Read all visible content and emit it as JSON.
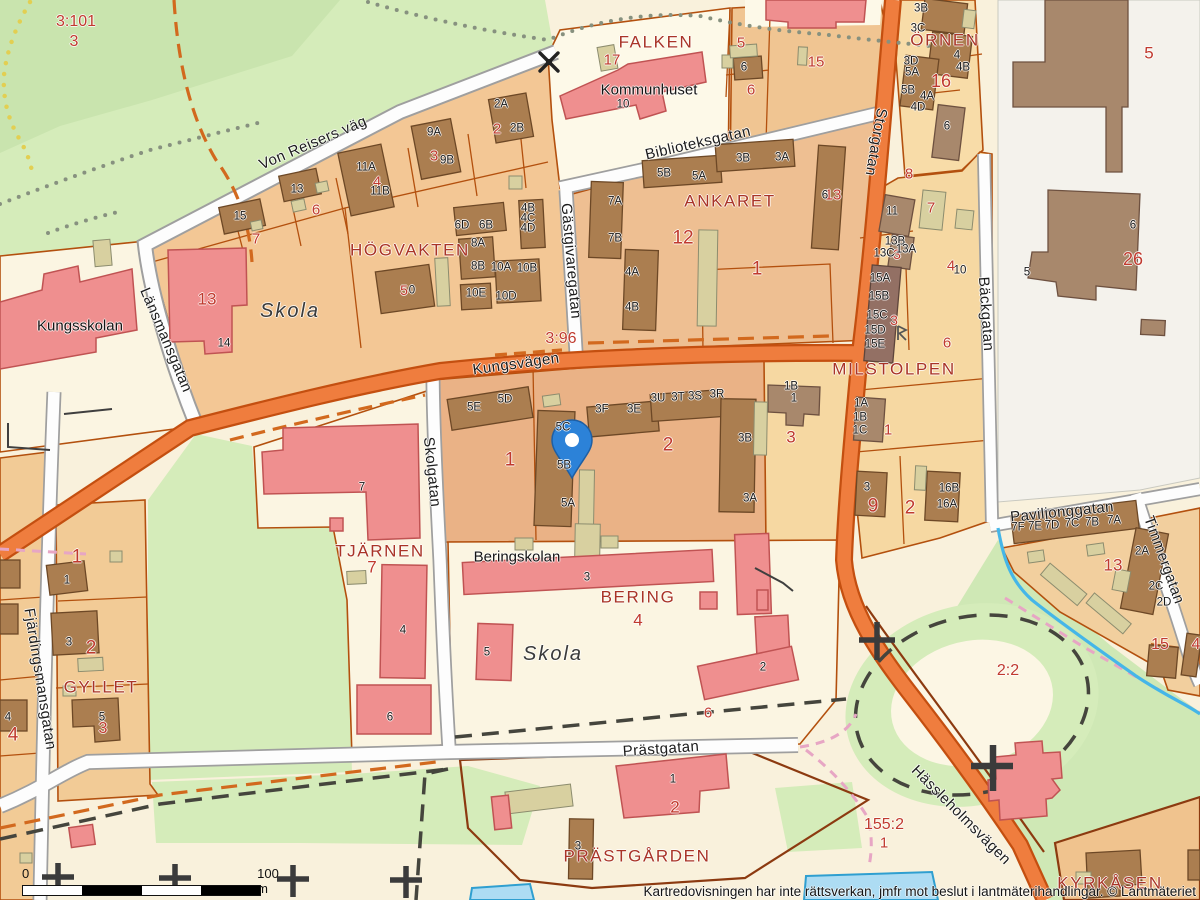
{
  "attribution": "Kartredovisningen har inte rättsverkan, jmfr mot beslut i lantmäterihandlingar. © Lantmäteriet",
  "scalebar": {
    "zero": "0",
    "hundred": "100 m"
  },
  "marker": {
    "x": 572,
    "y": 444,
    "color": "#2c82d8"
  },
  "colors": {
    "road_major": "#ef7d3e",
    "road_major_casing": "#c44f10",
    "road_minor": "#fdfdfd",
    "road_minor_casing": "#9f9f9f",
    "park": "#d5ecba",
    "water": "#addcf3",
    "water_line": "#45b6e8",
    "building": "#ab7e50",
    "public_building": "#ef8f8f",
    "shed": "#d8d0a0",
    "parcel_boundary": "#b3500e",
    "block_name": "#a93427",
    "parcel_number": "#c03a2e",
    "marker_blue": "#2c82d8"
  },
  "labels": {
    "streets": [
      {
        "t": "Von Reisers väg",
        "x": 313,
        "y": 143,
        "r": -23
      },
      {
        "t": "Biblioteksgatan",
        "x": 698,
        "y": 143,
        "r": -13
      },
      {
        "t": "Gästgivaregatan",
        "x": 571,
        "y": 261,
        "r": 85
      },
      {
        "t": "Storgatan",
        "x": 876,
        "y": 142,
        "r": 100
      },
      {
        "t": "Länsmansgatan",
        "x": 166,
        "y": 340,
        "r": 67
      },
      {
        "t": "Skolgatan",
        "x": 432,
        "y": 472,
        "r": 84
      },
      {
        "t": "Kungsvägen",
        "x": 516,
        "y": 364,
        "r": -8
      },
      {
        "t": "Fjärdingsmansgatan",
        "x": 40,
        "y": 679,
        "r": 81
      },
      {
        "t": "Bäckgatan",
        "x": 986,
        "y": 314,
        "r": 86
      },
      {
        "t": "Paviljonggatan",
        "x": 1062,
        "y": 512,
        "r": -6
      },
      {
        "t": "Timmergatan",
        "x": 1164,
        "y": 560,
        "r": 70
      },
      {
        "t": "Prästgatan",
        "x": 661,
        "y": 749,
        "r": -4
      },
      {
        "t": "Hässleholmsvägen",
        "x": 961,
        "y": 815,
        "r": 45
      }
    ],
    "blocks": [
      {
        "t": "FALKEN",
        "x": 656,
        "y": 42
      },
      {
        "t": "ÖRNEN",
        "x": 945,
        "y": 40
      },
      {
        "t": "ANKARET",
        "x": 730,
        "y": 201
      },
      {
        "t": "HÖGVAKTEN",
        "x": 410,
        "y": 250
      },
      {
        "t": "MILSTOLPEN",
        "x": 894,
        "y": 369
      },
      {
        "t": "TJÄRNEN",
        "x": 380,
        "y": 551
      },
      {
        "t": "GYLLET",
        "x": 101,
        "y": 687
      },
      {
        "t": "BERING",
        "x": 638,
        "y": 597
      },
      {
        "t": "PRÄSTGÅRDEN",
        "x": 637,
        "y": 856
      },
      {
        "t": "KYRKÅSEN",
        "x": 1110,
        "y": 883
      }
    ],
    "places": [
      {
        "t": "Kommunhuset",
        "x": 649,
        "y": 90
      },
      {
        "t": "Kungsskolan",
        "x": 80,
        "y": 326
      },
      {
        "t": "Beringskolan",
        "x": 517,
        "y": 557
      },
      {
        "t": "Skola",
        "x": 290,
        "y": 311,
        "i": 1,
        "s": 20
      },
      {
        "t": "Skola",
        "x": 553,
        "y": 654,
        "i": 1,
        "s": 20
      }
    ],
    "parcels_red": [
      {
        "t": "3:101",
        "x": 76,
        "y": 22,
        "s": 16
      },
      {
        "t": "3",
        "x": 74,
        "y": 42,
        "s": 16
      },
      {
        "t": "2",
        "x": 497,
        "y": 129
      },
      {
        "t": "3",
        "x": 434,
        "y": 156
      },
      {
        "t": "4",
        "x": 377,
        "y": 182
      },
      {
        "t": "6",
        "x": 316,
        "y": 210
      },
      {
        "t": "7",
        "x": 256,
        "y": 239
      },
      {
        "t": "17",
        "x": 612,
        "y": 60
      },
      {
        "t": "5",
        "x": 741,
        "y": 43
      },
      {
        "t": "6",
        "x": 751,
        "y": 90
      },
      {
        "t": "15",
        "x": 816,
        "y": 62
      },
      {
        "t": "16",
        "x": 941,
        "y": 81,
        "s": 18
      },
      {
        "t": "8",
        "x": 909,
        "y": 174
      },
      {
        "t": "5",
        "x": 1149,
        "y": 53,
        "s": 17
      },
      {
        "t": "26",
        "x": 1133,
        "y": 259,
        "s": 18
      },
      {
        "t": "7",
        "x": 931,
        "y": 208
      },
      {
        "t": "3",
        "x": 897,
        "y": 254,
        "s": 14
      },
      {
        "t": "4",
        "x": 951,
        "y": 266
      },
      {
        "t": "6",
        "x": 947,
        "y": 343
      },
      {
        "t": "3",
        "x": 894,
        "y": 320,
        "s": 14
      },
      {
        "t": "3:96",
        "x": 561,
        "y": 339,
        "s": 16
      },
      {
        "t": "13",
        "x": 833,
        "y": 195
      },
      {
        "t": "12",
        "x": 683,
        "y": 238,
        "s": 19
      },
      {
        "t": "1",
        "x": 757,
        "y": 269,
        "s": 19
      },
      {
        "t": "13",
        "x": 207,
        "y": 299,
        "s": 17
      },
      {
        "t": "1",
        "x": 510,
        "y": 460,
        "s": 19
      },
      {
        "t": "2",
        "x": 668,
        "y": 445,
        "s": 19
      },
      {
        "t": "3",
        "x": 791,
        "y": 437,
        "s": 17
      },
      {
        "t": "1",
        "x": 888,
        "y": 430
      },
      {
        "t": "9",
        "x": 873,
        "y": 506,
        "s": 19
      },
      {
        "t": "2",
        "x": 910,
        "y": 508,
        "s": 19
      },
      {
        "t": "7",
        "x": 372,
        "y": 567,
        "s": 17
      },
      {
        "t": "1",
        "x": 77,
        "y": 557,
        "s": 19
      },
      {
        "t": "2",
        "x": 91,
        "y": 648,
        "s": 19
      },
      {
        "t": "3",
        "x": 103,
        "y": 729,
        "s": 16
      },
      {
        "t": "4",
        "x": 13,
        "y": 735,
        "s": 19
      },
      {
        "t": "4",
        "x": 638,
        "y": 620,
        "s": 17
      },
      {
        "t": "6",
        "x": 708,
        "y": 713
      },
      {
        "t": "2",
        "x": 675,
        "y": 807,
        "s": 17
      },
      {
        "t": "155:2",
        "x": 884,
        "y": 825,
        "s": 16
      },
      {
        "t": "1",
        "x": 884,
        "y": 843
      },
      {
        "t": "2:2",
        "x": 1008,
        "y": 671,
        "s": 16
      },
      {
        "t": "13",
        "x": 1113,
        "y": 565,
        "s": 17
      },
      {
        "t": "15",
        "x": 1160,
        "y": 645,
        "s": 16
      },
      {
        "t": "4",
        "x": 1196,
        "y": 645,
        "s": 16
      },
      {
        "t": "5",
        "x": 404,
        "y": 290,
        "s": 14
      }
    ],
    "buildings_black": [
      {
        "t": "15",
        "x": 240,
        "y": 217
      },
      {
        "t": "13",
        "x": 297,
        "y": 190
      },
      {
        "t": "11A",
        "x": 366,
        "y": 168
      },
      {
        "t": "11B",
        "x": 380,
        "y": 192
      },
      {
        "t": "9A",
        "x": 434,
        "y": 133
      },
      {
        "t": "9B",
        "x": 447,
        "y": 161
      },
      {
        "t": "2A",
        "x": 501,
        "y": 105
      },
      {
        "t": "2B",
        "x": 517,
        "y": 129
      },
      {
        "t": "10",
        "x": 623,
        "y": 105
      },
      {
        "t": "6",
        "x": 744,
        "y": 68
      },
      {
        "t": "3B",
        "x": 921,
        "y": 9
      },
      {
        "t": "3C",
        "x": 918,
        "y": 29
      },
      {
        "t": "3D",
        "x": 911,
        "y": 62
      },
      {
        "t": "5A",
        "x": 912,
        "y": 73
      },
      {
        "t": "5B",
        "x": 908,
        "y": 91
      },
      {
        "t": "4A",
        "x": 927,
        "y": 97
      },
      {
        "t": "4D",
        "x": 918,
        "y": 108
      },
      {
        "t": "4",
        "x": 957,
        "y": 56
      },
      {
        "t": "4B",
        "x": 963,
        "y": 68
      },
      {
        "t": "6",
        "x": 947,
        "y": 127
      },
      {
        "t": "6",
        "x": 1133,
        "y": 226
      },
      {
        "t": "5",
        "x": 1027,
        "y": 273
      },
      {
        "t": "6D",
        "x": 462,
        "y": 226
      },
      {
        "t": "6B",
        "x": 486,
        "y": 226
      },
      {
        "t": "4B",
        "x": 528,
        "y": 209
      },
      {
        "t": "4C",
        "x": 528,
        "y": 219
      },
      {
        "t": "4D",
        "x": 528,
        "y": 229
      },
      {
        "t": "8A",
        "x": 478,
        "y": 244
      },
      {
        "t": "8B",
        "x": 478,
        "y": 267
      },
      {
        "t": "10A",
        "x": 501,
        "y": 268
      },
      {
        "t": "10B",
        "x": 527,
        "y": 269
      },
      {
        "t": "10E",
        "x": 476,
        "y": 294
      },
      {
        "t": "10D",
        "x": 506,
        "y": 297
      },
      {
        "t": "0",
        "x": 412,
        "y": 291
      },
      {
        "t": "5B",
        "x": 664,
        "y": 174
      },
      {
        "t": "5A",
        "x": 699,
        "y": 177
      },
      {
        "t": "3B",
        "x": 743,
        "y": 159
      },
      {
        "t": "3A",
        "x": 782,
        "y": 158
      },
      {
        "t": "7A",
        "x": 615,
        "y": 202
      },
      {
        "t": "7B",
        "x": 615,
        "y": 239
      },
      {
        "t": "4A",
        "x": 632,
        "y": 273
      },
      {
        "t": "4B",
        "x": 632,
        "y": 308
      },
      {
        "t": "6",
        "x": 825,
        "y": 196
      },
      {
        "t": "11",
        "x": 892,
        "y": 212
      },
      {
        "t": "13B",
        "x": 895,
        "y": 242
      },
      {
        "t": "13C",
        "x": 884,
        "y": 254
      },
      {
        "t": "13A",
        "x": 906,
        "y": 250
      },
      {
        "t": "15A",
        "x": 880,
        "y": 279
      },
      {
        "t": "15B",
        "x": 879,
        "y": 297
      },
      {
        "t": "15C",
        "x": 877,
        "y": 316
      },
      {
        "t": "15D",
        "x": 875,
        "y": 331
      },
      {
        "t": "15E",
        "x": 875,
        "y": 345
      },
      {
        "t": "10",
        "x": 960,
        "y": 271
      },
      {
        "t": "1A",
        "x": 861,
        "y": 404
      },
      {
        "t": "1B",
        "x": 860,
        "y": 418
      },
      {
        "t": "1C",
        "x": 860,
        "y": 431
      },
      {
        "t": "3",
        "x": 867,
        "y": 488
      },
      {
        "t": "16B",
        "x": 949,
        "y": 489
      },
      {
        "t": "16A",
        "x": 947,
        "y": 505
      },
      {
        "t": "5E",
        "x": 474,
        "y": 408
      },
      {
        "t": "5D",
        "x": 505,
        "y": 400
      },
      {
        "t": "5C",
        "x": 563,
        "y": 428
      },
      {
        "t": "5B",
        "x": 564,
        "y": 466
      },
      {
        "t": "5A",
        "x": 568,
        "y": 504
      },
      {
        "t": "3F",
        "x": 602,
        "y": 410
      },
      {
        "t": "3E",
        "x": 634,
        "y": 410
      },
      {
        "t": "3U",
        "x": 658,
        "y": 399
      },
      {
        "t": "3T",
        "x": 678,
        "y": 398
      },
      {
        "t": "3S",
        "x": 695,
        "y": 397
      },
      {
        "t": "3R",
        "x": 717,
        "y": 395
      },
      {
        "t": "3B",
        "x": 745,
        "y": 439
      },
      {
        "t": "3A",
        "x": 750,
        "y": 499
      },
      {
        "t": "1B",
        "x": 791,
        "y": 387
      },
      {
        "t": "1",
        "x": 794,
        "y": 399
      },
      {
        "t": "7",
        "x": 362,
        "y": 488
      },
      {
        "t": "4",
        "x": 403,
        "y": 631
      },
      {
        "t": "6",
        "x": 390,
        "y": 718
      },
      {
        "t": "14",
        "x": 224,
        "y": 344
      },
      {
        "t": "1",
        "x": 67,
        "y": 581
      },
      {
        "t": "3",
        "x": 69,
        "y": 643
      },
      {
        "t": "5",
        "x": 102,
        "y": 718
      },
      {
        "t": "4",
        "x": 8,
        "y": 718
      },
      {
        "t": "3",
        "x": 587,
        "y": 578
      },
      {
        "t": "5",
        "x": 487,
        "y": 653
      },
      {
        "t": "2",
        "x": 763,
        "y": 668
      },
      {
        "t": "1",
        "x": 673,
        "y": 780
      },
      {
        "t": "3",
        "x": 578,
        "y": 847
      },
      {
        "t": "7F",
        "x": 1018,
        "y": 528
      },
      {
        "t": "7E",
        "x": 1035,
        "y": 527
      },
      {
        "t": "7D",
        "x": 1052,
        "y": 526
      },
      {
        "t": "7C",
        "x": 1072,
        "y": 524
      },
      {
        "t": "7B",
        "x": 1092,
        "y": 523
      },
      {
        "t": "7A",
        "x": 1114,
        "y": 521
      },
      {
        "t": "2A",
        "x": 1142,
        "y": 552
      },
      {
        "t": "2C",
        "x": 1156,
        "y": 587
      },
      {
        "t": "2D",
        "x": 1164,
        "y": 603
      }
    ]
  }
}
